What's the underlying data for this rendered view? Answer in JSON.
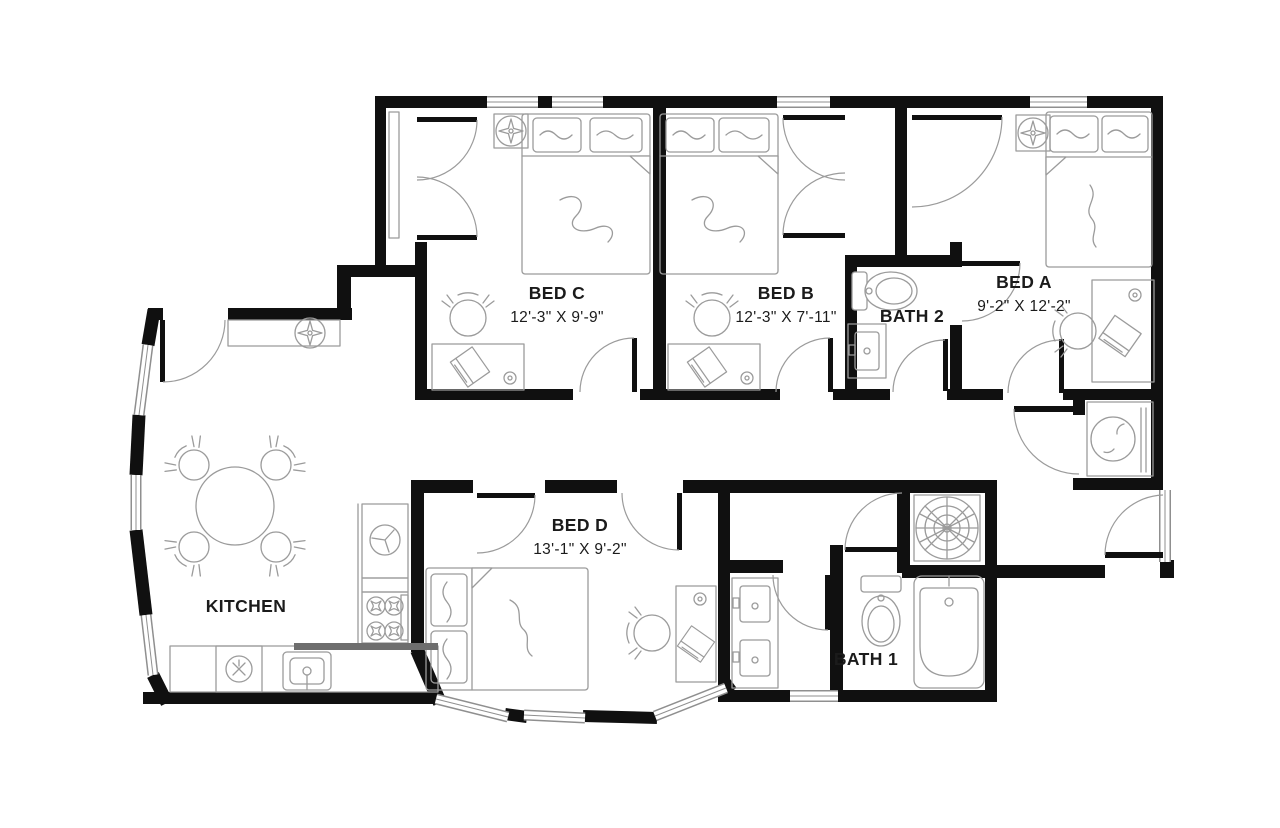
{
  "colors": {
    "wall": "#101010",
    "line": "#8f8f8f",
    "furniture": "#9b9b9b",
    "label": "#1b1b1b",
    "background": "#ffffff"
  },
  "rooms": {
    "bed_c": {
      "name": "BED C",
      "dims": "12'-3\" X 9'-9\""
    },
    "bed_b": {
      "name": "BED B",
      "dims": "12'-3\" X 7'-11\""
    },
    "bed_a": {
      "name": "BED A",
      "dims": "9'-2\" X 12'-2\""
    },
    "bed_d": {
      "name": "BED D",
      "dims": "13'-1\" X 9'-2\""
    },
    "bath_1": {
      "name": "BATH 1"
    },
    "bath_2": {
      "name": "BATH 2"
    },
    "kitchen": {
      "name": "KITCHEN"
    }
  }
}
